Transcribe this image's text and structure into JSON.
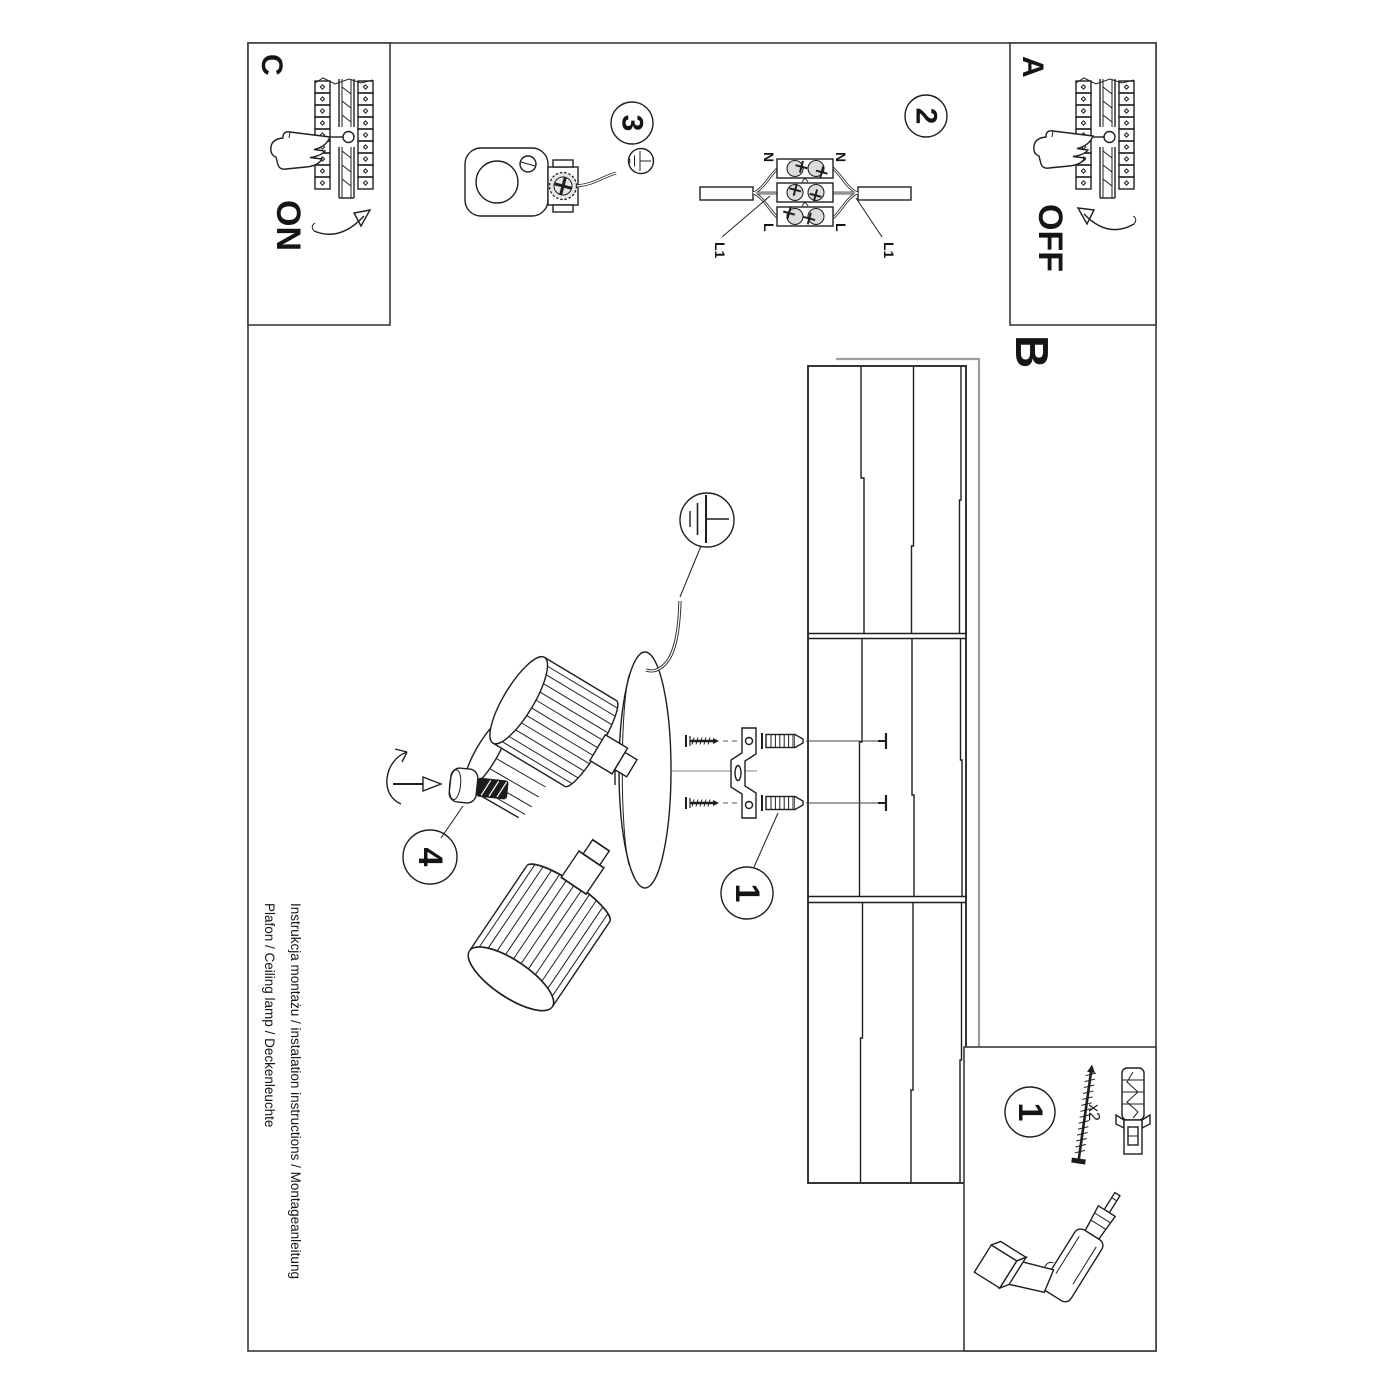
{
  "document": {
    "background": "#ffffff",
    "ink": "#1f1f1f",
    "muted_gray": "#9d9d9d"
  },
  "panels": {
    "c": {
      "label": "C",
      "action": "ON"
    },
    "a": {
      "label": "A",
      "action": "OFF"
    },
    "b": {
      "label": "B"
    }
  },
  "steps": {
    "one": "1",
    "two": "2",
    "three": "3",
    "four": "4"
  },
  "wiring": {
    "n_left": "N",
    "n_right": "N",
    "l_left": "L",
    "l_right": "L",
    "l1_left": "L1",
    "l1_right": "L1"
  },
  "parts_box": {
    "number": "1",
    "qty": "x2"
  },
  "footer": {
    "line1": "Instrukcja montażu / instalation instructions / Montageanleitung",
    "line2": "Plafon / Ceiling lamp / Deckenleuchte"
  }
}
